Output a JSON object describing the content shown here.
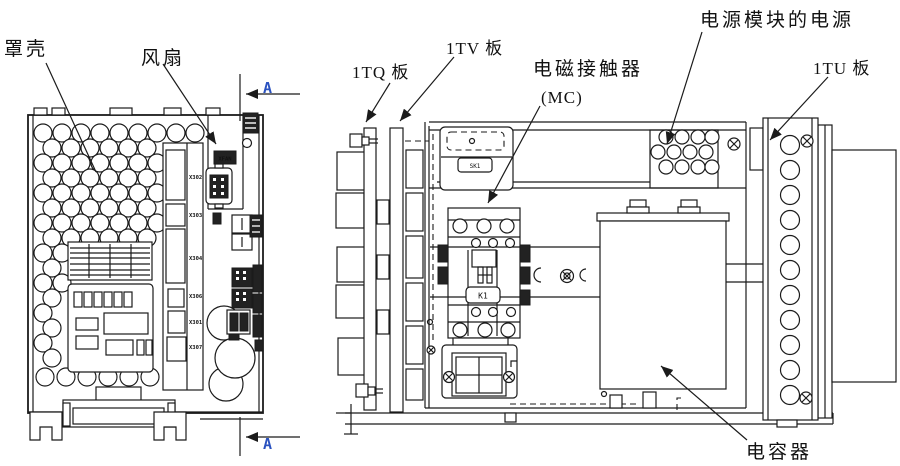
{
  "figure": {
    "background": "#ffffff",
    "ink_color": "#1b1b1b",
    "section_marker_color": "#2a52c0"
  },
  "left_view": {
    "labels": {
      "cover": "罩壳",
      "fan": "风扇"
    },
    "section_markers": {
      "top": "A",
      "bottom": "A"
    },
    "fan_connector_label": "XFAN",
    "connector_labels": [
      "X302",
      "X303",
      "X304",
      "X306",
      "X301",
      "X307"
    ]
  },
  "right_view": {
    "labels": {
      "board_1tq": "1TQ 板",
      "board_1tv": "1TV 板",
      "contactor_line1": "电磁接触器",
      "contactor_line2": "(MC)",
      "power_module_power": "电源模块的电源",
      "board_1tu": "1TU 板",
      "capacitor": "电容器"
    },
    "component_labels": {
      "relay": "SK1",
      "contactor": "K1"
    }
  }
}
